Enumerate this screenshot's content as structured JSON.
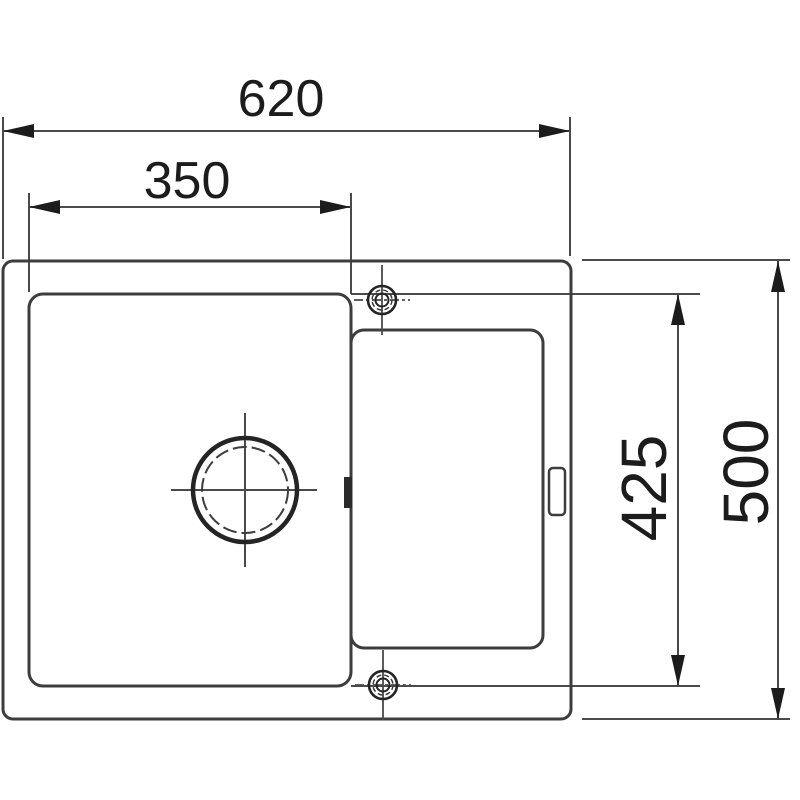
{
  "diagram": {
    "type": "technical-drawing",
    "subject": "inset-sink-top-view-with-drainboard",
    "units_implied": "mm",
    "colors": {
      "background": "#ffffff",
      "outline": "#3d3d3d",
      "thin_line": "#4a4a4a",
      "arrow_fill": "#1c1c1c",
      "text": "#1c1c1c",
      "overflow_fill": "#2a2a2a"
    },
    "dimensions": [
      {
        "id": "overall-width",
        "label": "620",
        "orientation": "horizontal",
        "measures": "outer rim left edge to right edge"
      },
      {
        "id": "bowl-width",
        "label": "350",
        "orientation": "horizontal",
        "measures": "bowl left edge to bowl right edge"
      },
      {
        "id": "bowl-depth",
        "label": "425",
        "orientation": "vertical",
        "measures": "bowl top edge to bowl bottom edge"
      },
      {
        "id": "overall-depth",
        "label": "500",
        "orientation": "vertical",
        "measures": "outer rim top edge to bottom edge"
      }
    ],
    "features": {
      "outer_rim": "sink-outer-outline",
      "bowl": "main-bowl-outline",
      "drainboard": "drainboard-inset-outline",
      "drain": "drain-hole-symbol",
      "tap_holes": [
        "tap-hole-top",
        "tap-hole-bottom"
      ],
      "overflow_slot": "overflow-slot-mark",
      "rim_slot": "rim-slot-mark"
    }
  }
}
